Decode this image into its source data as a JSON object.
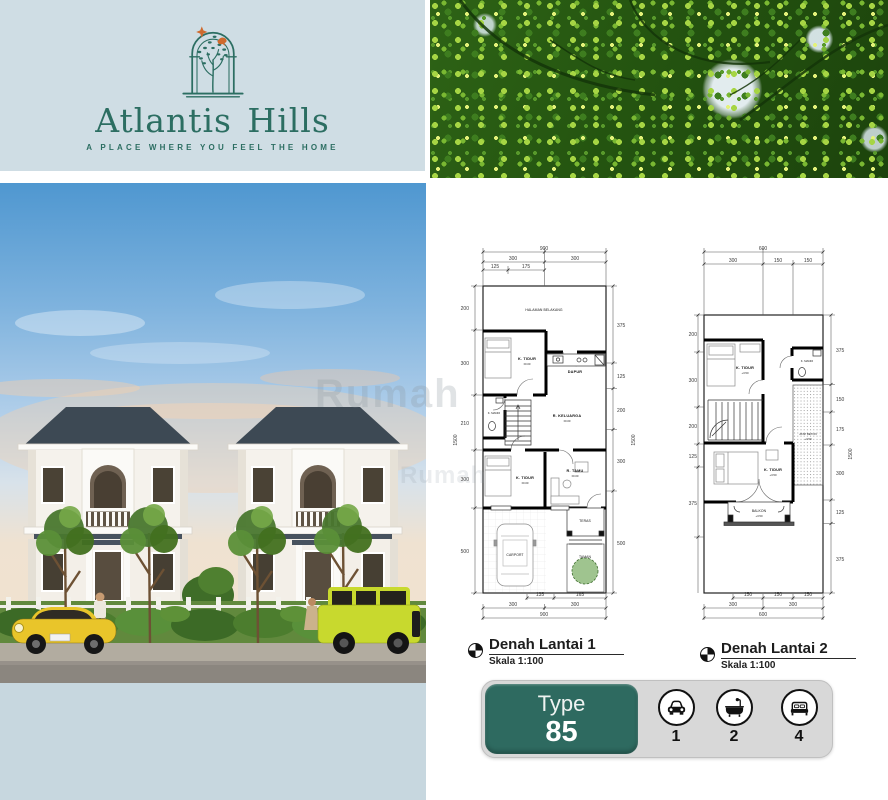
{
  "brand": {
    "name": "Atlantis Hills",
    "tagline": "A PLACE WHERE YOU FEEL THE HOME"
  },
  "watermark": {
    "text": "Rumah"
  },
  "colors": {
    "panel_blue": "#cfdde4",
    "strip_blue": "#c7d7df",
    "brand_teal": "#2c6e62",
    "badge_teal": "#2e6a60",
    "badge_gray": "#d8d8d8",
    "accent_orange": "#cf6a2e",
    "roof_slate": "#3d4954",
    "car_yellow": "#e9c52a",
    "foliage_green": "#2e6316"
  },
  "floorplans": [
    {
      "title": "Denah Lantai 1",
      "scale": "Skala 1:100",
      "elev": "±0.00",
      "rooms": [
        "HALAMAN BELAKANG",
        "K. TIDUR",
        "DAPUR",
        "K. MANDI",
        "R. KELUARGA",
        "K. TIDUR",
        "R. TAMU",
        "TERAS",
        "CARPORT",
        "TAMAN"
      ],
      "dims": {
        "top_total": "900",
        "top_mid": [
          "300",
          "300"
        ],
        "top_inner": [
          "125",
          "175"
        ],
        "left": [
          "200",
          "300",
          "210",
          "300",
          "500"
        ],
        "left_total": "1500",
        "right": [
          "375",
          "125",
          "200",
          "300",
          "500"
        ],
        "right_total": "1500",
        "bottom_inner": [
          "135",
          "165"
        ],
        "bottom_mid": [
          "300",
          "300"
        ],
        "bottom_total": "900"
      }
    },
    {
      "title": "Denah Lantai 2",
      "scale": "Skala 1:100",
      "elev": "+3.50",
      "rooms": [
        "K. TIDUR",
        "K. MANDI",
        "ATAP BETON",
        "K. TIDUR",
        "BALKON"
      ],
      "dims": {
        "top_total": "600",
        "top_mid": [
          "300",
          "150",
          "150"
        ],
        "left": [
          "200",
          "300",
          "200",
          "125",
          "375"
        ],
        "right": [
          "375",
          "150",
          "175",
          "300",
          "125",
          "375"
        ],
        "right_total": "1500",
        "bottom_inner": [
          "150",
          "150",
          "150"
        ],
        "bottom_mid": [
          "300",
          "300"
        ],
        "bottom_total": "600"
      }
    }
  ],
  "type_badge": {
    "label": "Type",
    "value": "85",
    "features": [
      {
        "icon": "car-icon",
        "count": "1"
      },
      {
        "icon": "bathtub-icon",
        "count": "2"
      },
      {
        "icon": "bed-icon",
        "count": "4"
      }
    ]
  }
}
